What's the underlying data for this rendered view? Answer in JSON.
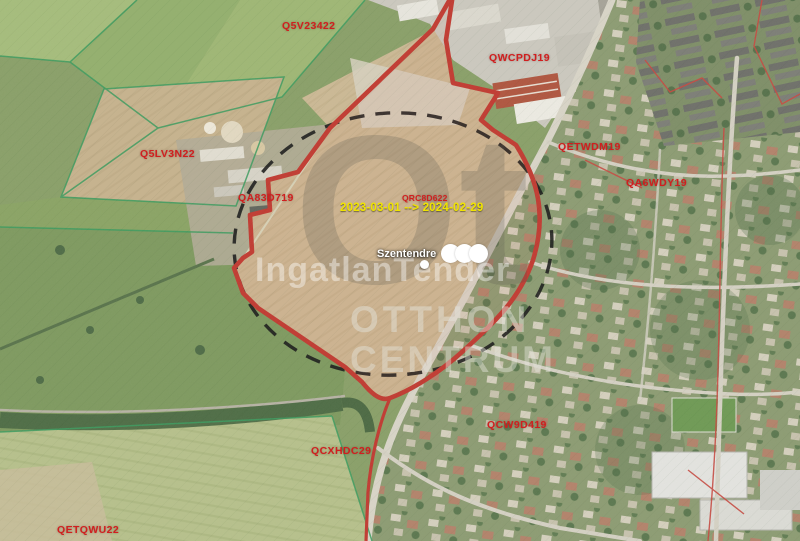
{
  "map": {
    "place_label": "Szentendre",
    "date_range": "2023-03-01 --> 2024-02-29",
    "watermark": {
      "brand": "IngatlanTender",
      "monogram": "Ot",
      "line1": "OTTHON",
      "line2": "CENTRUM"
    },
    "parcel_labels": [
      {
        "id": "Q5V23422",
        "x": 282,
        "y": 20
      },
      {
        "id": "QWCPDJ19",
        "x": 489,
        "y": 52
      },
      {
        "id": "Q5LV3N22",
        "x": 140,
        "y": 148
      },
      {
        "id": "QA83D719",
        "x": 238,
        "y": 192
      },
      {
        "id": "QRC8D622",
        "x": 402,
        "y": 193,
        "small": true
      },
      {
        "id": "QETWDM19",
        "x": 558,
        "y": 141
      },
      {
        "id": "QA6WDY19",
        "x": 626,
        "y": 177
      },
      {
        "id": "QCW9D419",
        "x": 487,
        "y": 419
      },
      {
        "id": "QCXHDC29",
        "x": 311,
        "y": 445
      },
      {
        "id": "QETQWU22",
        "x": 57,
        "y": 524
      }
    ],
    "colors": {
      "parcel_label": "#d01f1f",
      "date_label": "#f0e400",
      "boundary_red": "#c23b32",
      "boundary_green": "#3d9c60",
      "dashed_black": "#191919"
    }
  }
}
